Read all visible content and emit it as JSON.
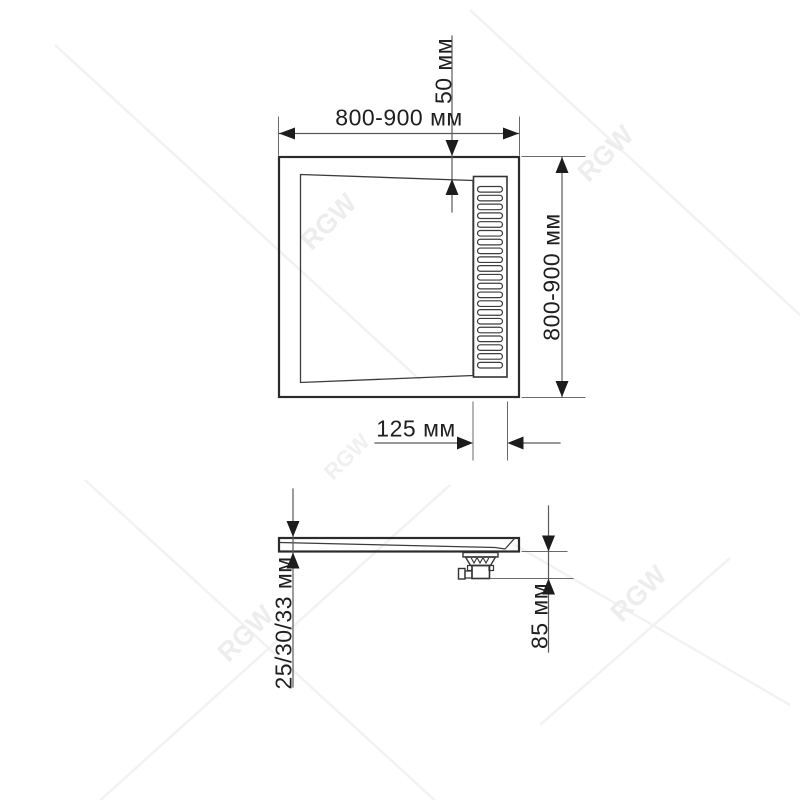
{
  "watermark": {
    "text": "RGW"
  },
  "top_view": {
    "width_dimension_label": "800-900 мм",
    "height_dimension_label": "800-900 мм",
    "drain_edge_offset_label": "50 мм",
    "drain_grate_width_label": "125 мм",
    "grate": {
      "slot_count": 21
    }
  },
  "side_view": {
    "tray_thickness_label": "25/30/33 мм",
    "drain_trap_height_label": "85 мм"
  },
  "colors": {
    "background": "#ffffff",
    "outline": "#2b2b2b",
    "thin_line": "#3c3c3c",
    "dim_line": "#5a5a5a",
    "arrow": "#1c1c1c",
    "text": "#1f1f1f",
    "watermark": "#ededed"
  }
}
